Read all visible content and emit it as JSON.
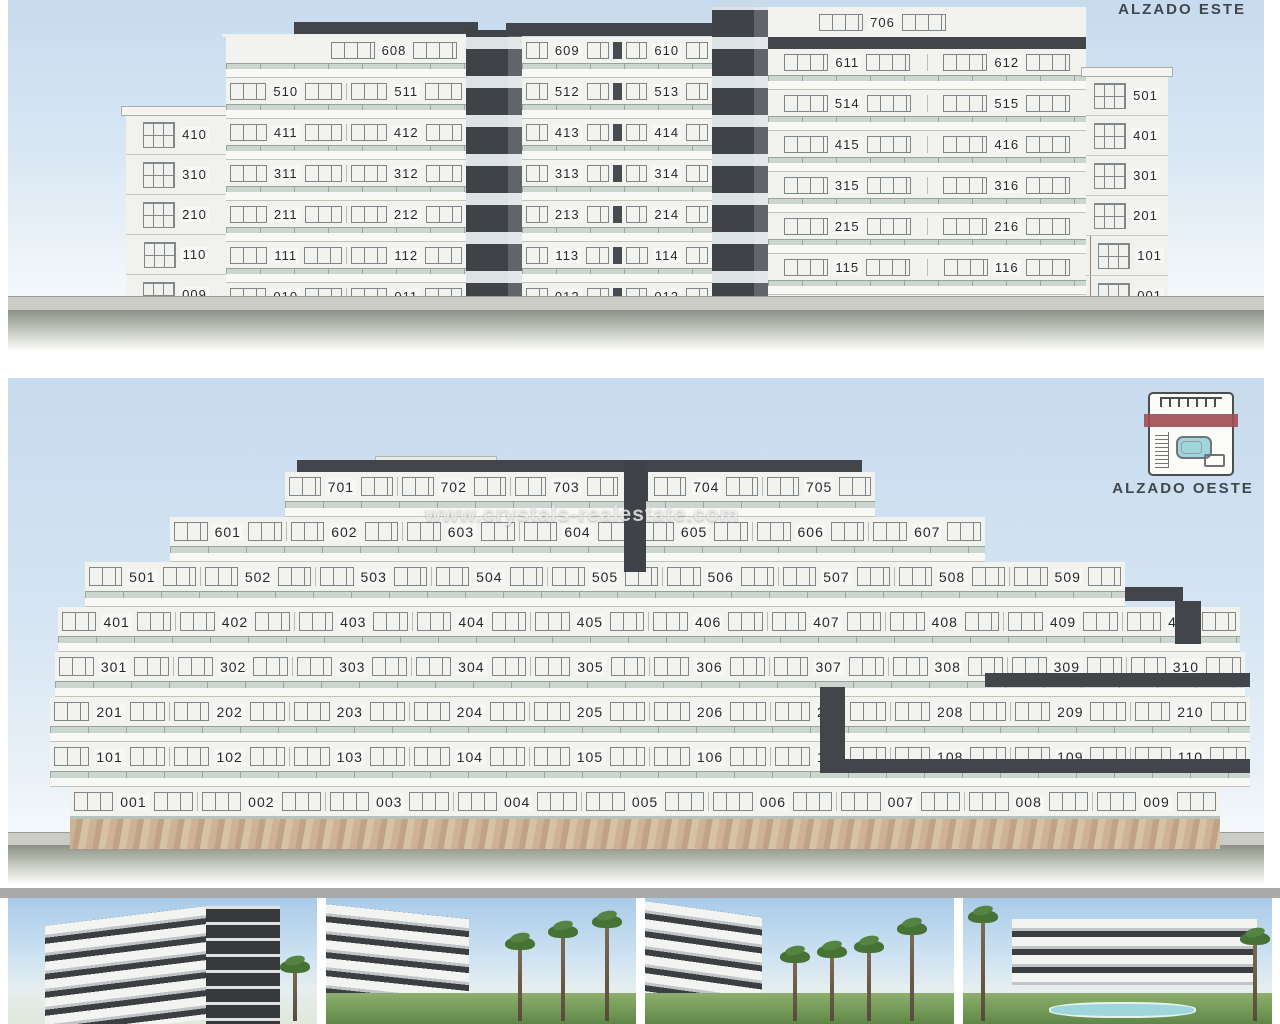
{
  "east": {
    "title": "ALZADO ESTE",
    "blocks": {
      "left_tower": [
        "410",
        "310",
        "210",
        "110",
        "009"
      ],
      "left_block": [
        [
          "608"
        ],
        [
          "510",
          "511"
        ],
        [
          "411",
          "412"
        ],
        [
          "311",
          "312"
        ],
        [
          "211",
          "212"
        ],
        [
          "111",
          "112"
        ],
        [
          "010",
          "011"
        ]
      ],
      "mid_block": [
        [
          "609",
          "610"
        ],
        [
          "512",
          "513"
        ],
        [
          "413",
          "414"
        ],
        [
          "313",
          "314"
        ],
        [
          "213",
          "214"
        ],
        [
          "113",
          "114"
        ],
        [
          "012",
          "013"
        ]
      ],
      "right_block": [
        [
          "706"
        ],
        [
          "611",
          "612"
        ],
        [
          "514",
          "515"
        ],
        [
          "415",
          "416"
        ],
        [
          "315",
          "316"
        ],
        [
          "215",
          "216"
        ],
        [
          "115",
          "116"
        ],
        [
          "014",
          "015"
        ]
      ],
      "right_tower": [
        "501",
        "401",
        "301",
        "201",
        "101",
        "001"
      ]
    }
  },
  "west": {
    "title": "ALZADO OESTE",
    "floors": [
      [
        "701",
        "702",
        "703",
        "704",
        "705"
      ],
      [
        "601",
        "602",
        "603",
        "604",
        "605",
        "606",
        "607"
      ],
      [
        "501",
        "502",
        "503",
        "504",
        "505",
        "506",
        "507",
        "508",
        "509"
      ],
      [
        "401",
        "402",
        "403",
        "404",
        "405",
        "406",
        "407",
        "408",
        "409",
        "410"
      ],
      [
        "301",
        "302",
        "303",
        "304",
        "305",
        "306",
        "307",
        "308",
        "309",
        "310"
      ],
      [
        "201",
        "202",
        "203",
        "204",
        "205",
        "206",
        "207",
        "208",
        "209",
        "210"
      ],
      [
        "101",
        "102",
        "103",
        "104",
        "105",
        "106",
        "107",
        "108",
        "109",
        "110"
      ],
      [
        "001",
        "002",
        "003",
        "004",
        "005",
        "006",
        "007",
        "008",
        "009"
      ]
    ]
  },
  "watermark": "www.crystals-realestate.com",
  "colors": {
    "facade_dark": "#3f4347",
    "facade_white": "#f2f2ef",
    "balcony_glass": "#ccd6d0",
    "icon_band_red": "#a04d53",
    "sky": "#c7dbee",
    "stone": "#c8ab8c"
  },
  "photo_count": "4"
}
